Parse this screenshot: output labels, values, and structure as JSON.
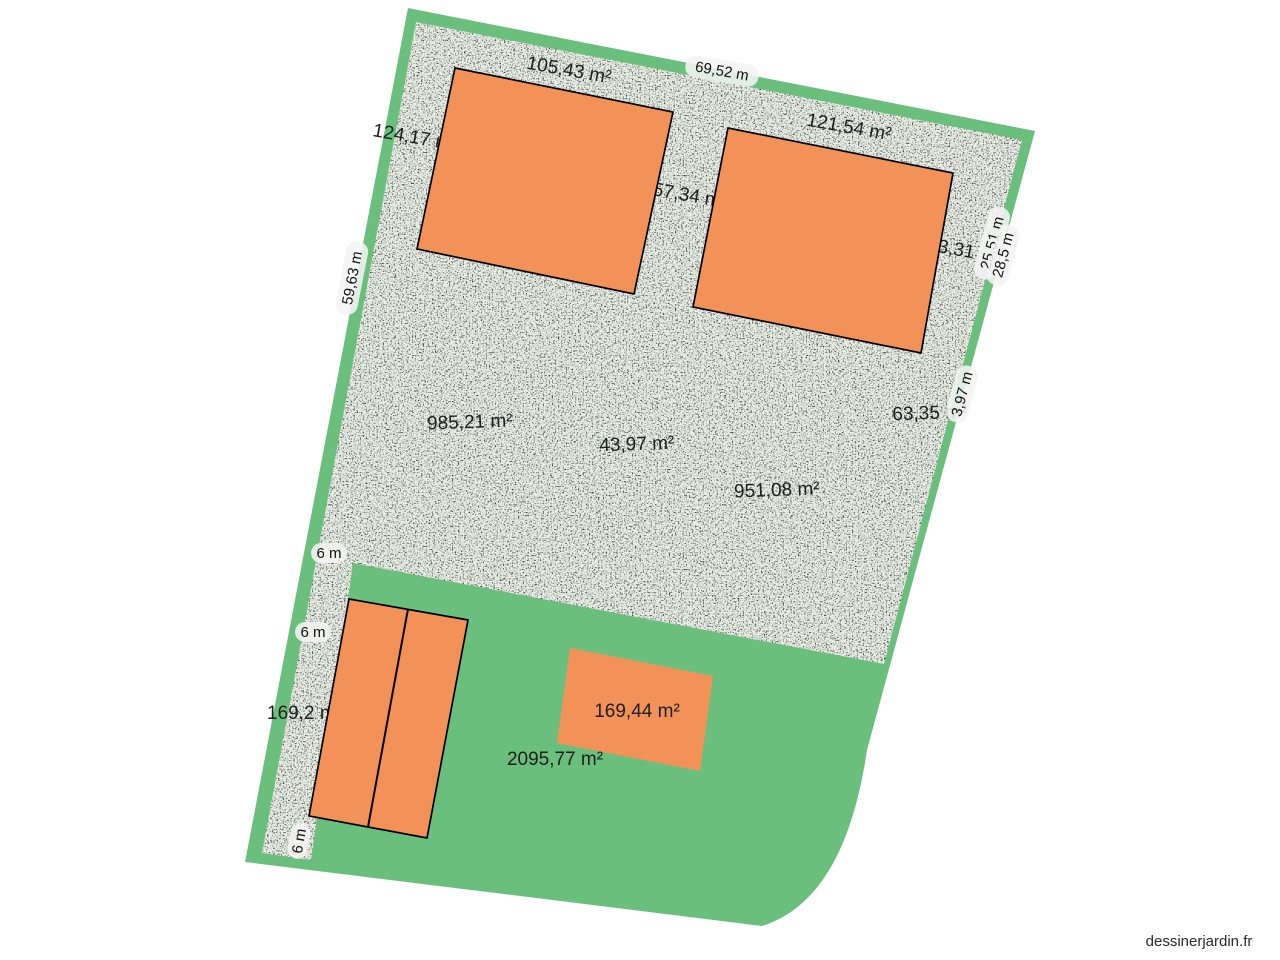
{
  "app": {
    "watermark": "dessinerjardin.fr"
  },
  "plan": {
    "description": "Garden / land plot drawing with gravel zones (textured), lawn zones (green) and buildings (orange)",
    "colors": {
      "lawn_green": "#6abf7c",
      "gravel_base": "#c6d0c2",
      "building_orange": "#f29258",
      "building_outline": "#000000",
      "label_text": "#1e1e1e",
      "measure_pill_bg": "#f3f3f3"
    },
    "area_labels": [
      {
        "id": "gravel-top-left",
        "text": "105,43 m²"
      },
      {
        "id": "left-strip-upper",
        "text": "124,17 m²"
      },
      {
        "id": "gravel-top-right",
        "text": "121,54 m²"
      },
      {
        "id": "between-buildings",
        "text": "57,34 m"
      },
      {
        "id": "right-edge-zone",
        "text": "3,31"
      },
      {
        "id": "gravel-center-left",
        "text": "985,21 m²"
      },
      {
        "id": "gravel-center",
        "text": "43,97 m²"
      },
      {
        "id": "gravel-right",
        "text": "63,35 m²"
      },
      {
        "id": "gravel-center-right",
        "text": "951,08 m²"
      },
      {
        "id": "left-driveway",
        "text": "169,2 m²"
      },
      {
        "id": "small-building",
        "text": "169,44 m²"
      },
      {
        "id": "lawn-bottom",
        "text": "2095,77 m²"
      }
    ],
    "measure_labels": [
      {
        "id": "top-edge",
        "text": "69,52 m"
      },
      {
        "id": "left-edge",
        "text": "59,63 m"
      },
      {
        "id": "right-edge-a",
        "text": "25,51 m"
      },
      {
        "id": "right-edge-b",
        "text": "28,5 m"
      },
      {
        "id": "building-edge-hidden",
        "text": "13,9 m"
      },
      {
        "id": "right-edge-c",
        "text": "3,97 m"
      },
      {
        "id": "driveway-width-1",
        "text": "6 m"
      },
      {
        "id": "driveway-width-2",
        "text": "6 m"
      },
      {
        "id": "driveway-width-3",
        "text": "6 m"
      }
    ]
  }
}
